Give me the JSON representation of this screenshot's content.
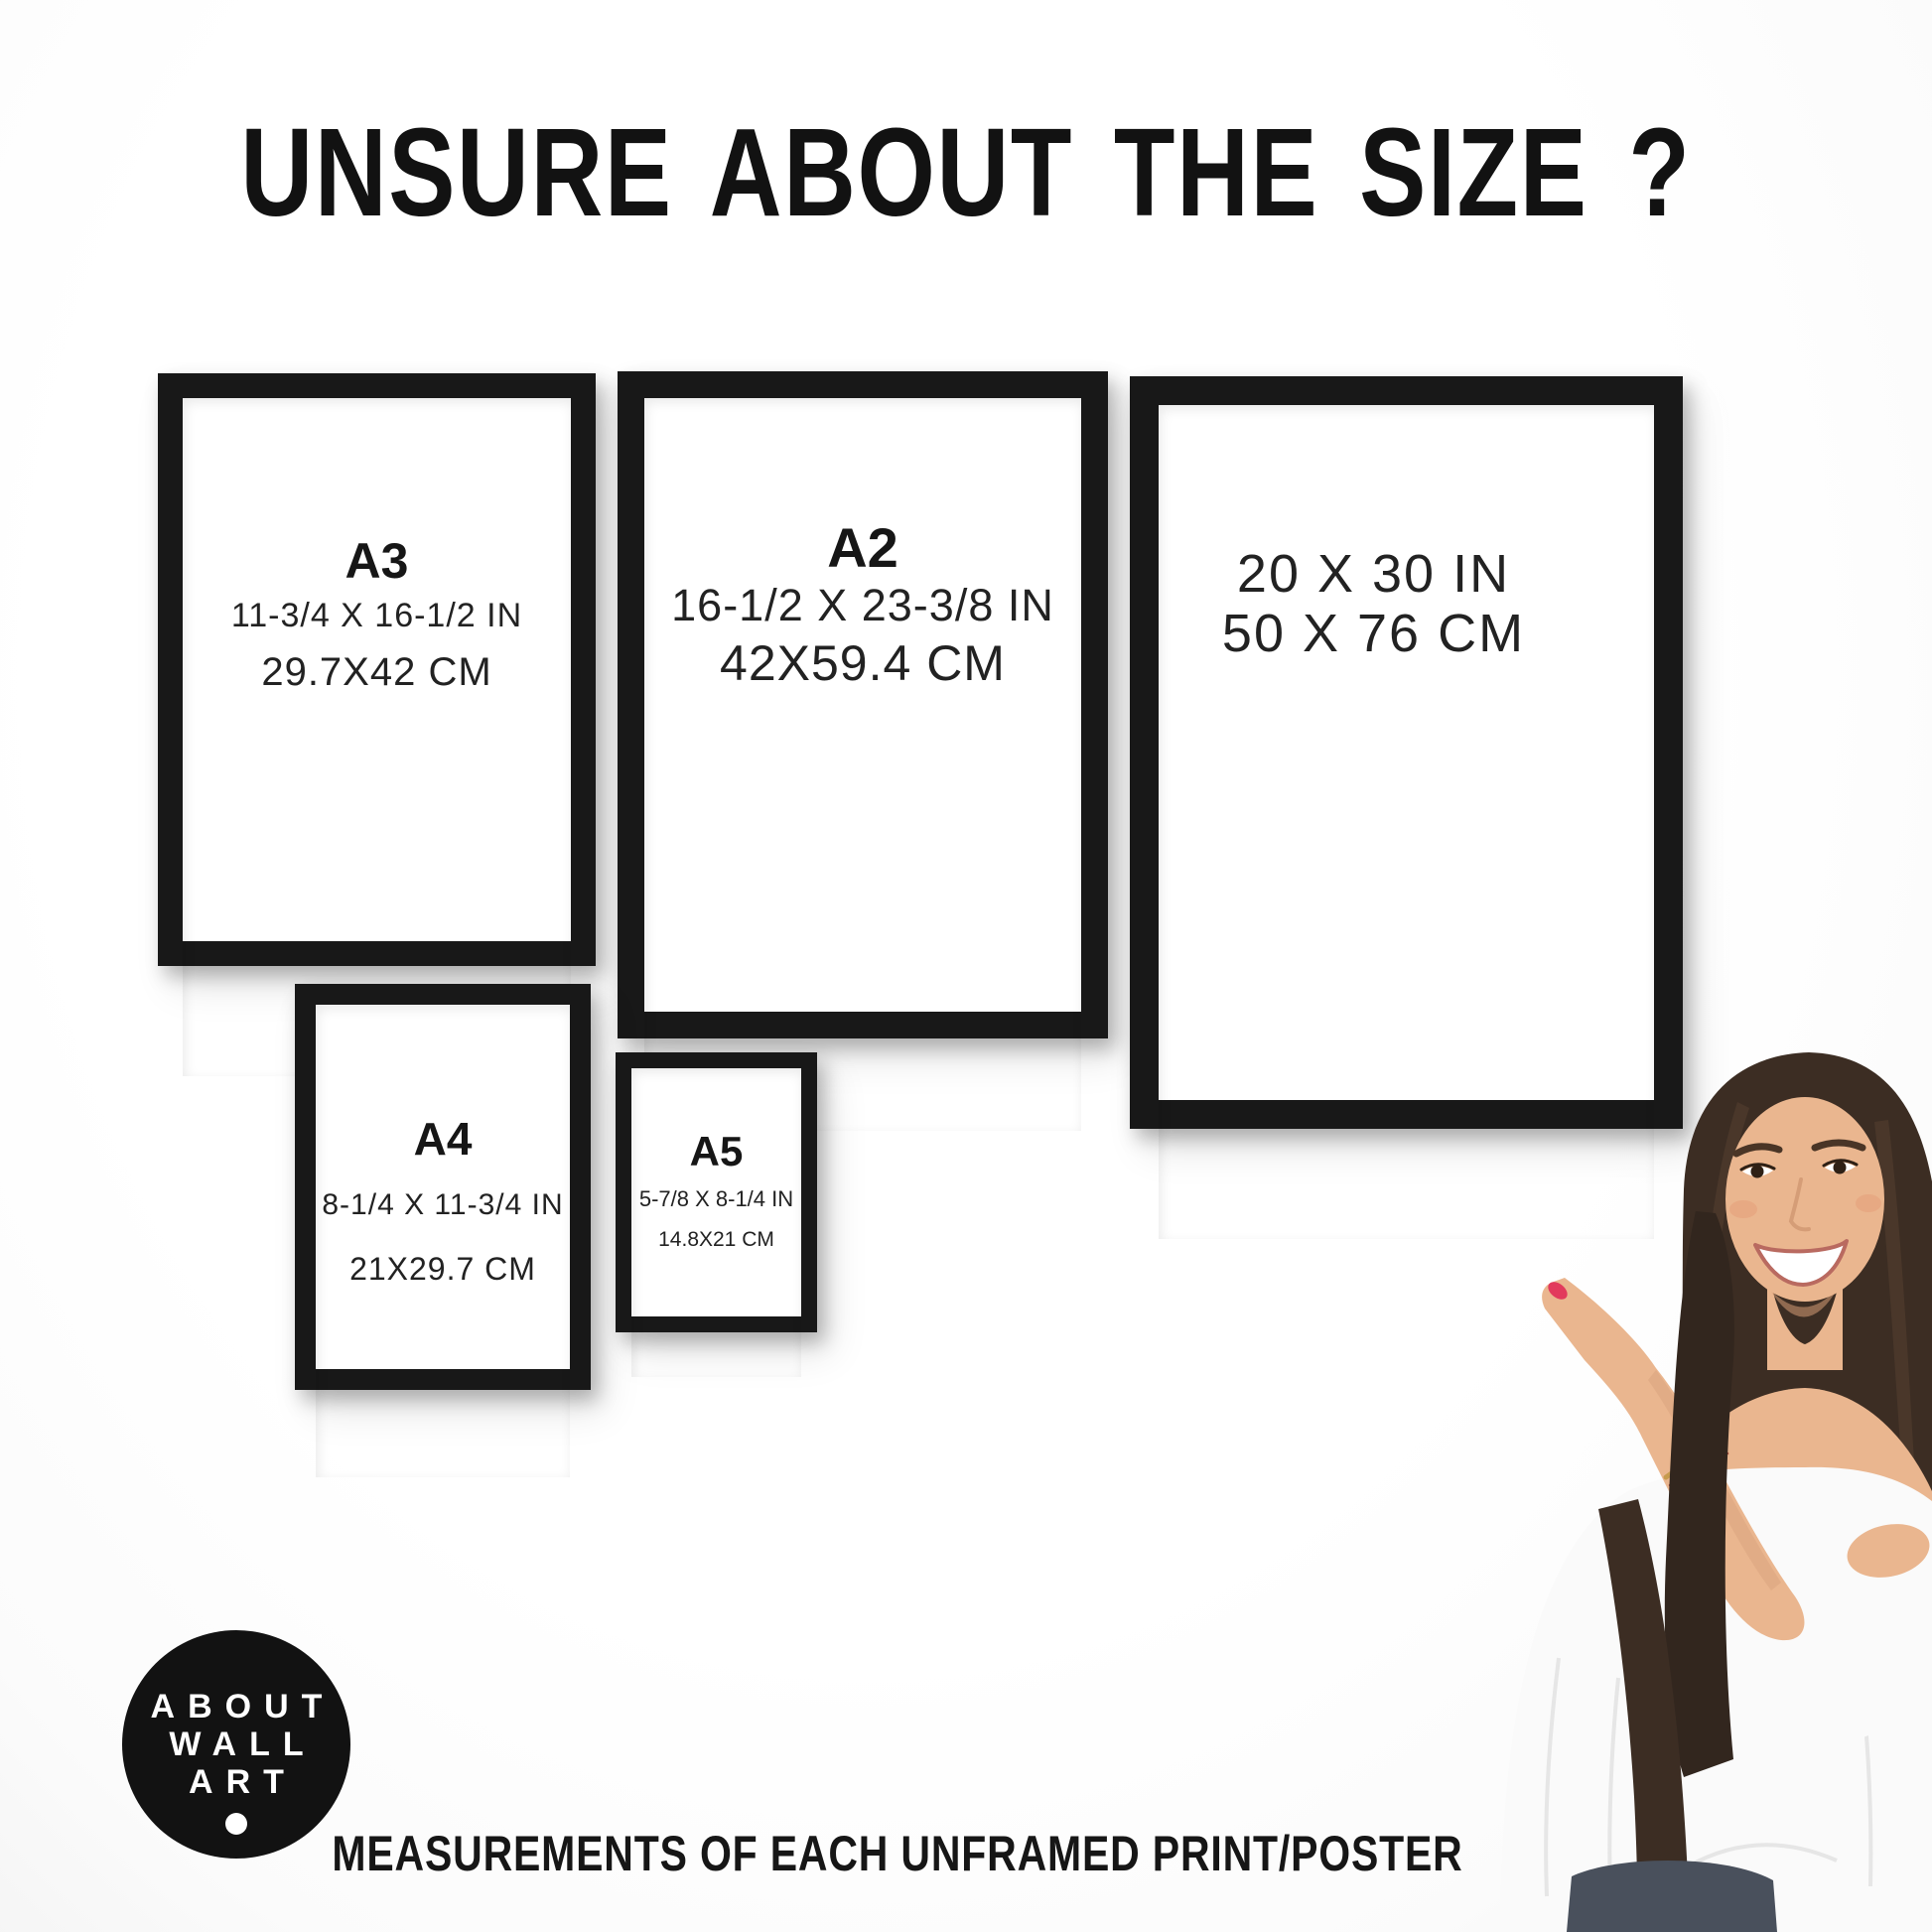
{
  "title": "UNSURE ABOUT THE SIZE ?",
  "frames": [
    {
      "id": "a3",
      "label": "A3",
      "size_in": "11-3/4 X 16-1/2 IN",
      "size_cm": "29.7X42 CM"
    },
    {
      "id": "a2",
      "label": "A2",
      "size_in": "16-1/2 X 23-3/8 IN",
      "size_cm": "42X59.4 CM"
    },
    {
      "id": "20x30",
      "label": "",
      "size_in": "20 X 30 IN",
      "size_cm": "50 X 76 CM"
    },
    {
      "id": "a4",
      "label": "A4",
      "size_in": "8-1/4 X 11-3/4 IN",
      "size_cm": "21X29.7 CM"
    },
    {
      "id": "a5",
      "label": "A5",
      "size_in": "5-7/8 X 8-1/4 IN",
      "size_cm": "14.8X21 CM"
    }
  ],
  "logo": {
    "lines": [
      "ABOUT",
      "WALL",
      "ART"
    ]
  },
  "caption": "MEASUREMENTS OF EACH UNFRAMED PRINT/POSTER",
  "colors": {
    "frame": "#181818",
    "wall": "#ffffff",
    "text": "#1d1d1d",
    "logo_bg": "#121212",
    "logo_text": "#ffffff",
    "hair": "#3c2d23",
    "skin": "#eab68f",
    "blouse": "#fafafa",
    "jeans": "#49505c",
    "nail": "#e23a5c"
  }
}
